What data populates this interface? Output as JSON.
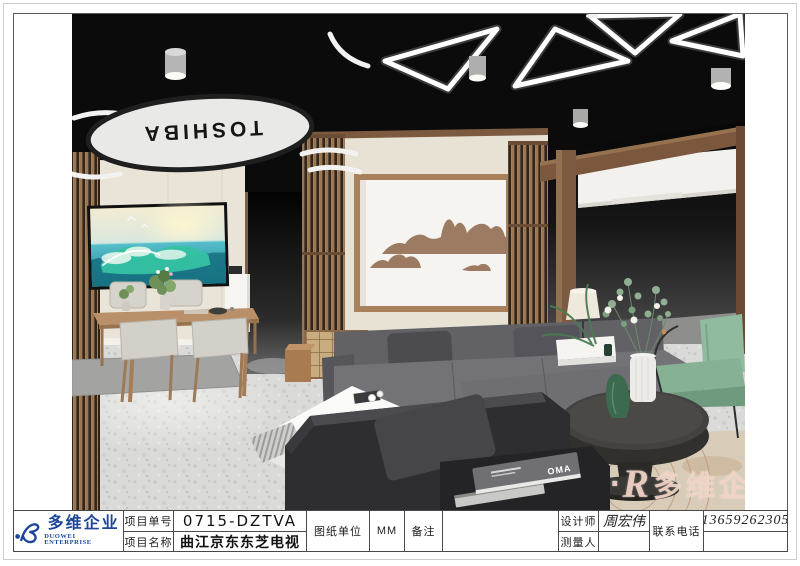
{
  "title_block": {
    "logo": {
      "name_cn": "多维企业",
      "name_en": "DUOWEI ENTERPRISE"
    },
    "fields": {
      "project_no_label": "项目单号",
      "project_no": "0715-DZTVA",
      "project_name_label": "项目名称",
      "project_name": "曲江京东东芝电视",
      "unit_label": "图纸单位",
      "unit": "MM",
      "remark_label": "备注",
      "remark": "",
      "designer_label": "设计师",
      "designer": "周宏伟",
      "surveyor_label": "测量人",
      "surveyor": "",
      "phone_label": "联系电话",
      "phone": "13659262305",
      "phone_row2": ""
    }
  },
  "watermark": {
    "dot": "·",
    "mark": "R",
    "text": "多维企"
  },
  "scene": {
    "brand_sign": "TOSHIBA",
    "book_title": "OMA"
  },
  "colors": {
    "logo_blue": "#1d4699",
    "watermark_pink": "rgba(242,209,196,0.9)",
    "ceiling_black": "#0b0b0b",
    "wood": "#8d6749",
    "wall_beige": "#eae4d8",
    "sofa_gray": "#6e6e72",
    "chair_green": "#87b195"
  }
}
